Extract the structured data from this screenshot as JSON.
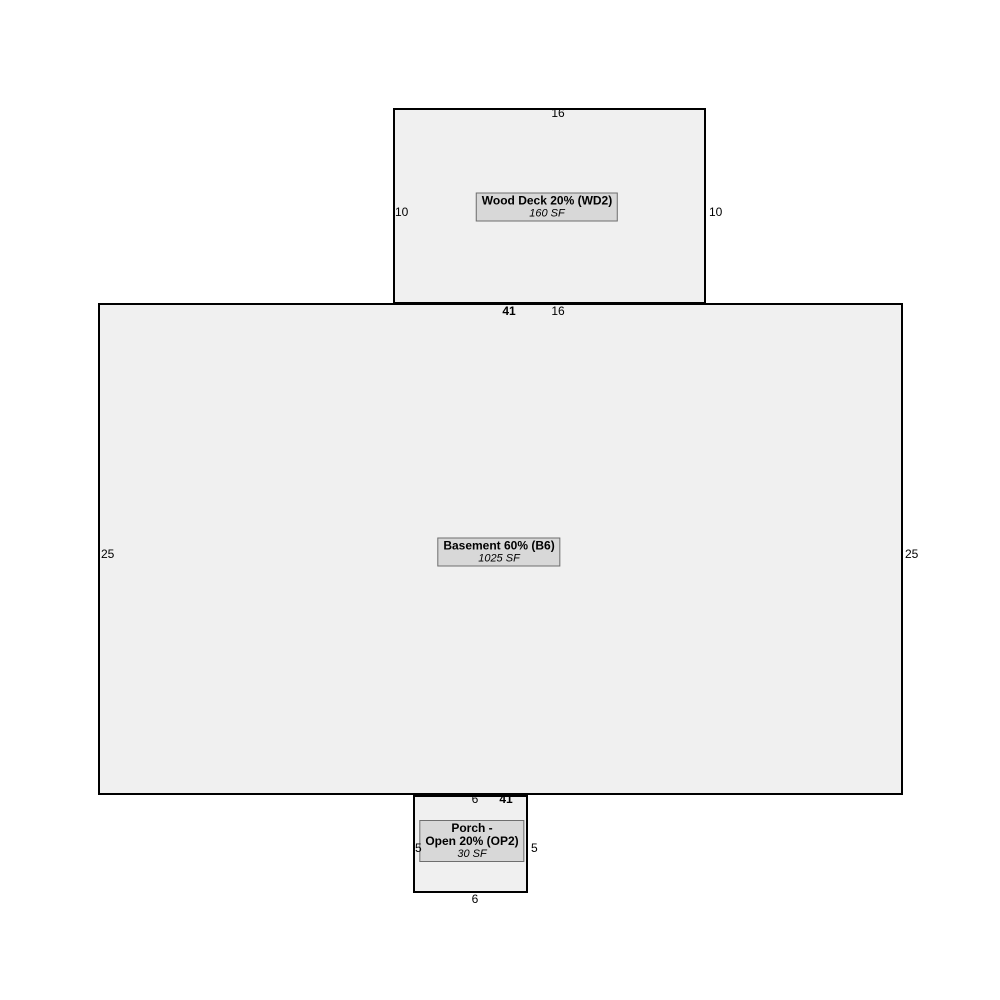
{
  "colors": {
    "background": "#ffffff",
    "area_fill": "#f0f0f0",
    "area_border": "#000000",
    "label_fill": "#d8d8d8",
    "label_border": "#6e6e6e",
    "text": "#000000"
  },
  "areas": {
    "wood_deck": {
      "label": "Wood Deck 20% (WD2)",
      "sf": "160 SF",
      "dim_top": "16",
      "dim_left": "10",
      "dim_right": "10",
      "dim_bottom": "16"
    },
    "basement": {
      "label": "Basement 60% (B6)",
      "sf": "1025 SF",
      "dim_top": "41",
      "dim_left": "25",
      "dim_right": "25",
      "dim_bottom": "41"
    },
    "porch": {
      "label_line1": "Porch -",
      "label_line2": "Open 20% (OP2)",
      "sf": "30 SF",
      "dim_top": "6",
      "dim_left": "5",
      "dim_right": "5",
      "dim_bottom": "6"
    }
  }
}
